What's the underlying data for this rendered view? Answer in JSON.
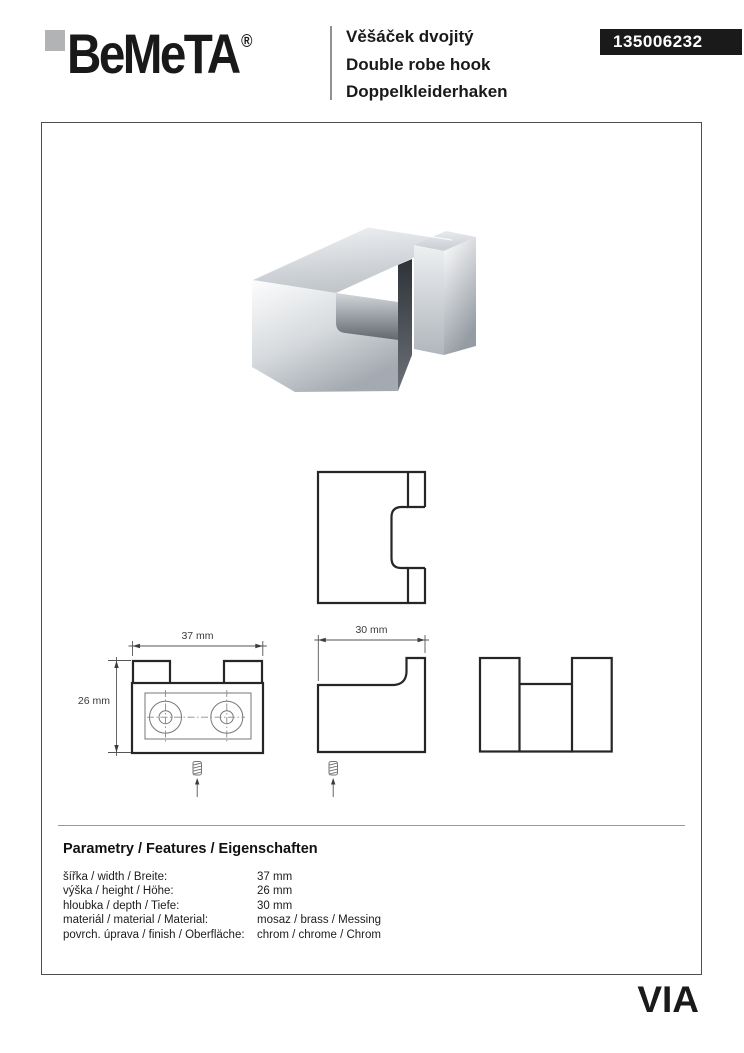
{
  "header": {
    "brand": "BeMeTA",
    "registered_mark": "®",
    "titles": [
      "Věšáček dvojitý",
      "Double robe hook",
      "Doppelkleiderhaken"
    ],
    "product_code": "135006232"
  },
  "drawings": {
    "width_label": "37 mm",
    "height_label": "26 mm",
    "depth_label": "30 mm"
  },
  "parameters": {
    "heading": "Parametry / Features / Eigenschaften",
    "rows": [
      {
        "label": "šířka / width / Breite:",
        "value": "37 mm"
      },
      {
        "label": "výška / height / Höhe:",
        "value": "26 mm"
      },
      {
        "label": "hloubka / depth / Tiefe:",
        "value": "30 mm"
      },
      {
        "label": "materiál / material / Material:",
        "value": "mosaz / brass / Messing"
      },
      {
        "label": "povrch. úprava / finish / Oberfläche:",
        "value": "chrom / chrome / Chrom"
      }
    ]
  },
  "footer": {
    "series_logo": "VIA"
  },
  "colors": {
    "code_badge_bg": "#1a1a1a",
    "logo_square": "#b1b3b5",
    "drawing_line": "#262626",
    "text": "#1a1a1a"
  }
}
